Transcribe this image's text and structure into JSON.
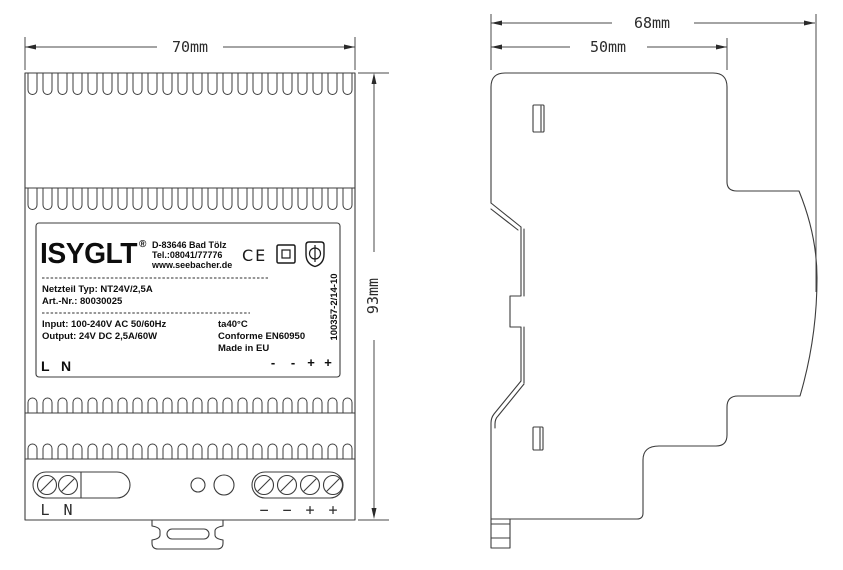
{
  "front_view": {
    "dim_width": "70mm",
    "dim_height": "93mm",
    "label": {
      "brand": "ISYGLT",
      "reg_mark": "®",
      "address_line1": "D-83646 Bad Tölz",
      "address_line2": "Tel.:08041/77776",
      "address_line3": "www.seebacher.de",
      "ce_mark": "CE",
      "type_line": "Netzteil Typ: NT24V/2,5A",
      "artnr_line": "Art.-Nr.: 80030025",
      "input_line": "Input: 100-240V AC 50/60Hz",
      "output_line": "Output: 24V DC 2,5A/60W",
      "temp_line": "ta40°C",
      "conformity_line": "Conforme EN60950",
      "origin_line": "Made in EU",
      "serial_number": "100357-2/14-10",
      "terminal_l": "L",
      "terminal_n": "N",
      "polarity": [
        "-",
        "-",
        "+",
        "+"
      ]
    },
    "terminals": {
      "l": "L",
      "n": "N",
      "polarity": [
        "−",
        "−",
        "+",
        "+"
      ]
    }
  },
  "side_view": {
    "dim_total_depth": "68mm",
    "dim_body_depth": "50mm"
  },
  "colors": {
    "line": "#3c3c3c",
    "text": "#111111"
  }
}
